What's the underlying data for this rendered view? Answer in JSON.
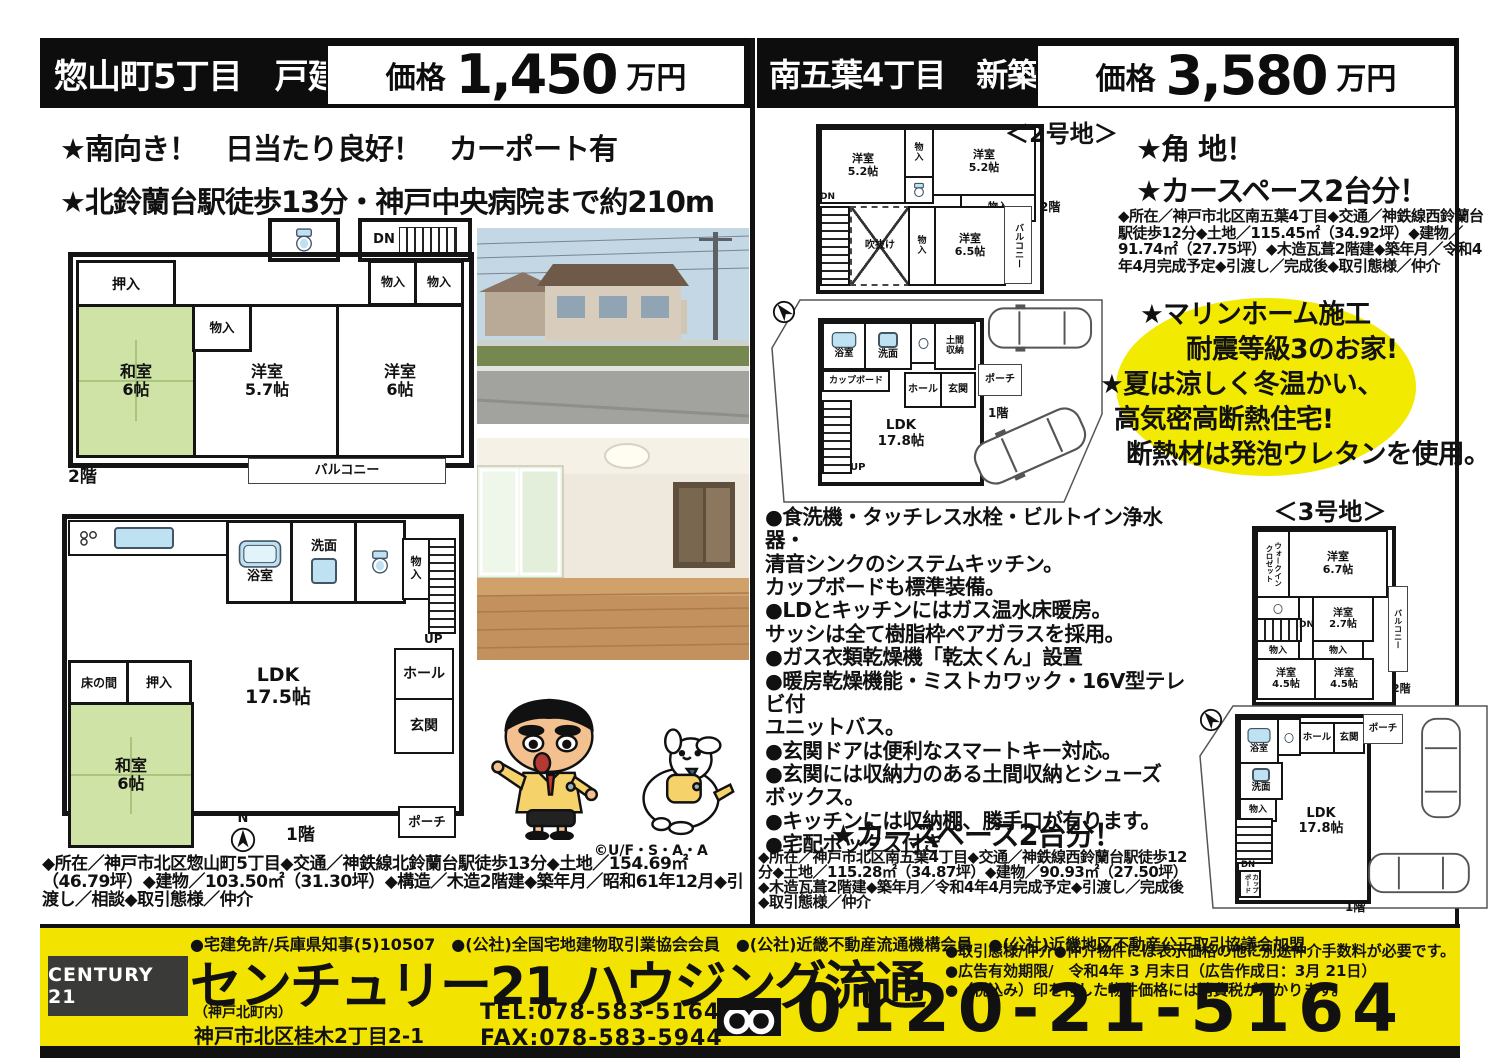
{
  "rooms": {
    "oshiire": "押入",
    "monoire": "物入",
    "monoire_v": "物\n入",
    "washitsu6": "和室\n6帖",
    "yoshitsu57": "洋室\n5.7帖",
    "yoshitsu6": "洋室\n6帖",
    "balcony": "バルコニー",
    "dn": "DN",
    "up": "UP",
    "floor1": "1階",
    "floor2": "2階",
    "yokushitsu": "浴室",
    "senmen": "洗面",
    "hall": "ホール",
    "genkan": "玄関",
    "porch": "ポーチ",
    "ldk175": "LDK\n17.5帖",
    "tokonoma": "床の間",
    "yoshitsu52": "洋室\n5.2帖",
    "fukinuke": "吹抜け",
    "yoshitsu65": "洋室\n6.5帖",
    "ldk178": "LDK\n17.8帖",
    "cupboard": "カップボード",
    "doma": "土間\n収納",
    "wic": "ウォークイン\nクロゼット",
    "yoshitsu67": "洋室\n6.7帖",
    "yoshitsu27": "洋室\n2.7帖",
    "yoshitsu45": "洋室\n4.5帖",
    "north": "N"
  },
  "left": {
    "header": {
      "title": "惣山町5丁目　戸建",
      "price_label": "価格",
      "price_value": "1,450",
      "price_unit": "万円"
    },
    "features": [
      "★南向き！　日当たり良好！　カーポート有",
      "★北鈴蘭台駅徒歩13分・神戸中央病院まで約210m"
    ],
    "details": "◆所在／神戸市北区惣山町5丁目◆交通／神鉄線北鈴蘭台駅徒歩13分◆土地／154.69㎡（46.79坪）◆建物／103.50㎡（31.30坪）◆構造／木造2階建◆築年月／昭和61年12月◆引渡し／相談◆取引態様／仲介",
    "mascot_copyright": "©U/F・S・A・A"
  },
  "right": {
    "header": {
      "title": "南五葉4丁目　新築戸建",
      "price_label": "価格",
      "price_value": "3,580",
      "price_unit": "万円"
    },
    "lot2_title": "＜2号地＞",
    "lot3_title": "＜3号地＞",
    "feature1": "★角 地！",
    "feature2": "★カースペース2台分！",
    "details_top": "◆所在／神戸市北区南五葉4丁目◆交通／神鉄線西鈴蘭台駅徒歩12分◆土地／115.45㎡（34.92坪）◆建物／91.74㎡（27.75坪）◆木造瓦葺2階建◆築年月／令和4年4月完成予定◆引渡し／完成後◆取引態様／仲介",
    "highlight": [
      "★マリンホーム施工",
      "耐震等級3のお家!",
      "★夏は涼しく冬温かい、",
      "高気密高断熱住宅!",
      "断熱材は発泡ウレタンを使用。"
    ],
    "bullets": "●食洗機・タッチレス水栓・ビルトイン浄水器・\n清音シンクのシステムキッチン。\nカップボードも標準装備。\n●LDとキッチンにはガス温水床暖房。\nサッシは全て樹脂枠ペアガラスを採用。\n●ガス衣類乾燥機「乾太くん」設置\n●暖房乾燥機能・ミストカワック・16V型テレビ付\nユニットバス。\n●玄関ドアは便利なスマートキー対応。\n●玄関には収納力のある土間収納とシューズ\nボックス。\n●キッチンには収納棚、勝手口が有ります。\n●宅配ボックス付き",
    "carspace": "★カースペース2台分！",
    "details_bottom": "◆所在／神戸市北区南五葉4丁目◆交通／神鉄線西鈴蘭台駅徒歩12分◆土地／115.28㎡（34.87坪）◆建物／90.93㎡（27.50坪）◆木造瓦葺2階建◆築年月／令和4年4月完成予定◆引渡し／完成後◆取引態様／仲介"
  },
  "footer": {
    "license_line": "●宅建免許/兵庫県知事(5)10507　●(公社)全国宅地建物取引業協会会員　●(公社)近畿不動産流通機構会員　●(公社)近畿地区不動産公正取引協議会加盟",
    "brand": "CENTURY 21",
    "company": "センチュリー21 ハウジング流通",
    "branch": "（神戸北町内）",
    "address": "神戸市北区桂木2丁目2-1",
    "tel": "TEL:078-583-5164",
    "fax": "FAX:078-583-5944",
    "freedial": "0120-21-5164",
    "notes": "●取引態様/仲介●仲介物件には表示価格の他に別途仲介手数料が必要です。\n●広告有効期限/　令和4年 3 月末日（広告作成日：3月 21日）\n●（税込み）印を付した物件価格には消費税がかかります。"
  },
  "colors": {
    "footer_yellow": "#f2e300",
    "highlight_yellow": "#f2ea00",
    "tatami_green": "#cfe3a6",
    "fixture_blue": "#bfe2f2",
    "brand_gray": "#3a3a38"
  }
}
